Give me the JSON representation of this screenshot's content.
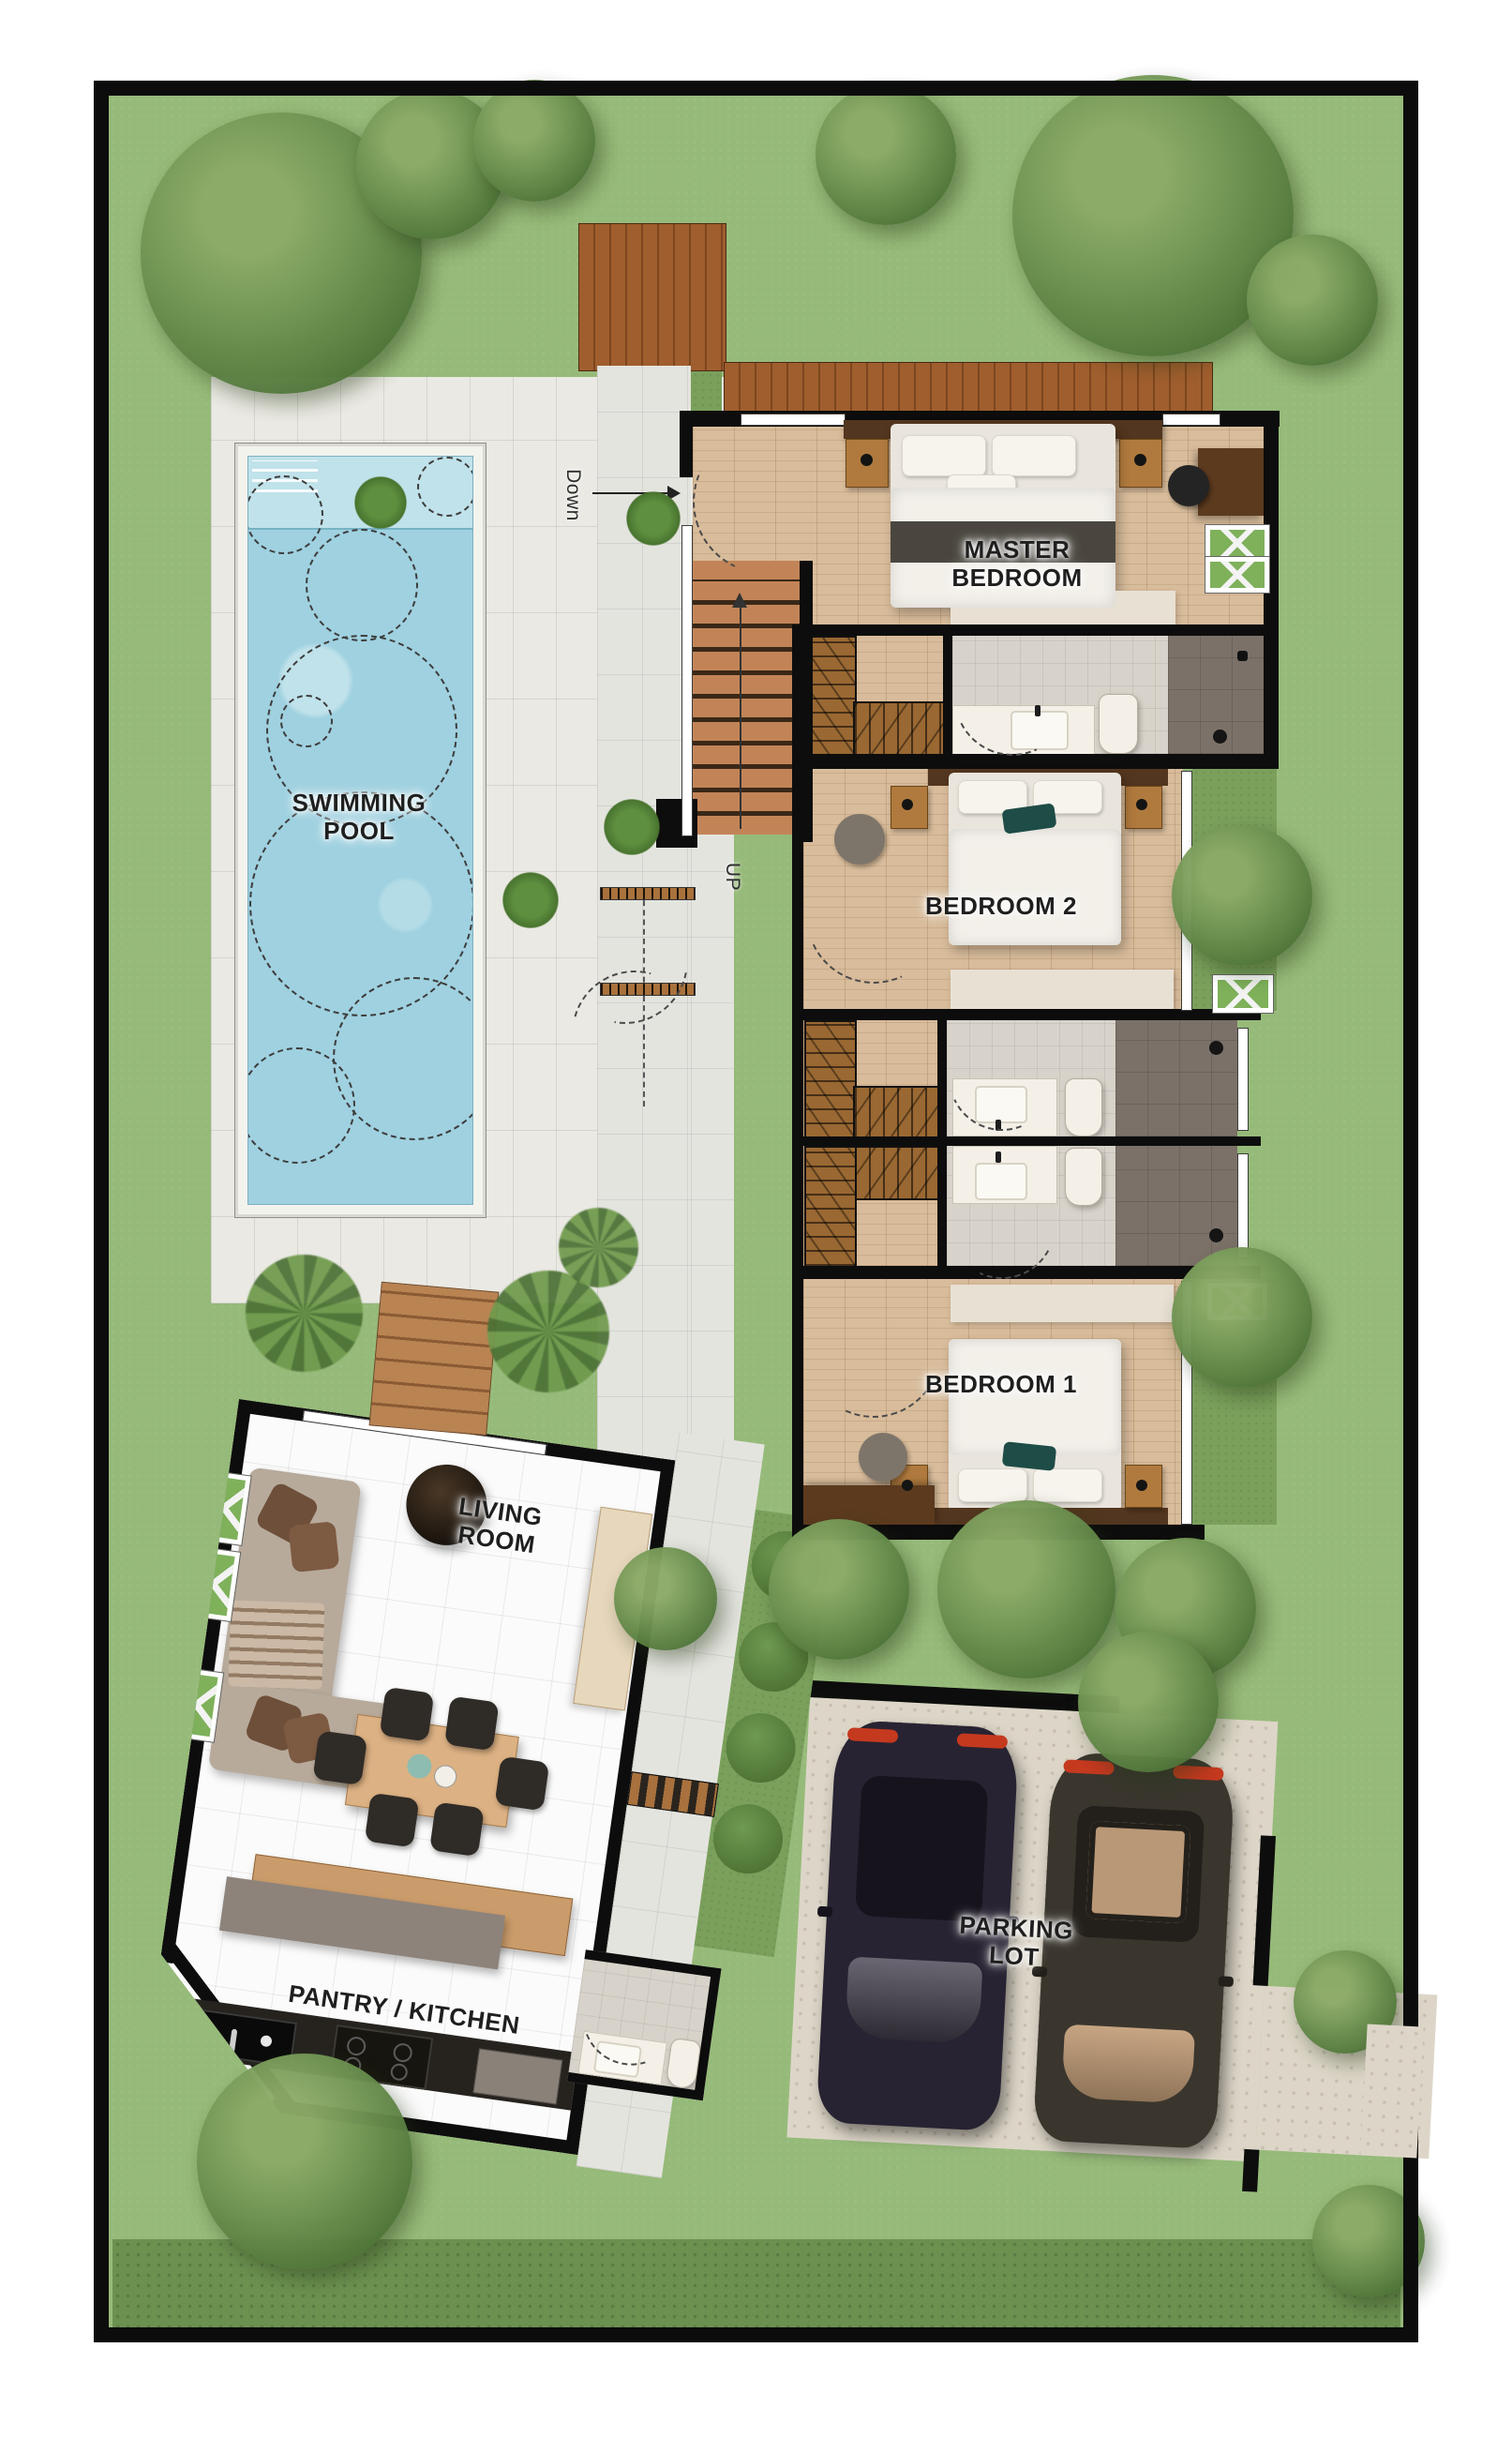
{
  "plan": {
    "title": "Villa ground floor plan",
    "labels": {
      "swimming_pool": "SWIMMING POOL",
      "master_bedroom": "MASTER BEDROOM",
      "bedroom_2": "BEDROOM 2",
      "bedroom_1": "BEDROOM 1",
      "living_room": "LIVING ROOM",
      "pantry_kitchen": "PANTRY / KITCHEN",
      "parking_lot": "PARKING LOT"
    },
    "stairs": {
      "down": "Down",
      "up": "UP"
    },
    "colors": {
      "grass": "#96ba79",
      "grass_dark": "#7aa05c",
      "hedge": "#6b9150",
      "tree_light": "#8cab68",
      "tree_mid": "#6c9150",
      "tree_dark": "#4c7136",
      "palm": "#6f9a4c",
      "pool_water": "#9fd1e0",
      "pool_shallow": "#c0e2ea",
      "pool_coping": "#f3f3ee",
      "deck_tile": "#eae9e3",
      "path_tile": "#e4e4df",
      "wood_deck": "#a05e2e",
      "boardwalk": "#b98352",
      "stair_wood": "#c28457",
      "closet_wood": "#9a6832",
      "parquet": "#d8bc9b",
      "wall": "#0d0d0d",
      "bath_tile": "#d8d3ca",
      "shower": "#7b7168",
      "fixture": "#f4f0e8",
      "living_floor": "#fbfbfb",
      "counter": "#26231f",
      "island_wood": "#cb9c6b",
      "island_gray": "#8d837b",
      "table_wood": "#dcb183",
      "chair": "#2f2b26",
      "sofa": "#b7aa9b",
      "pillow_brown": "#6e4f3a",
      "rug": "#e8e0d3",
      "paving": "#ddd6c8",
      "car_a": "#282332",
      "car_b": "#3a362e",
      "taillight": "#c5391f",
      "headboard": "#53361f",
      "desk_wood": "#5c3a1e",
      "teal_pillow": "#1e4c46",
      "blanket": "#4a463f",
      "planter_green": "#7fb15b",
      "label_ink": "#1f1f1f"
    }
  }
}
